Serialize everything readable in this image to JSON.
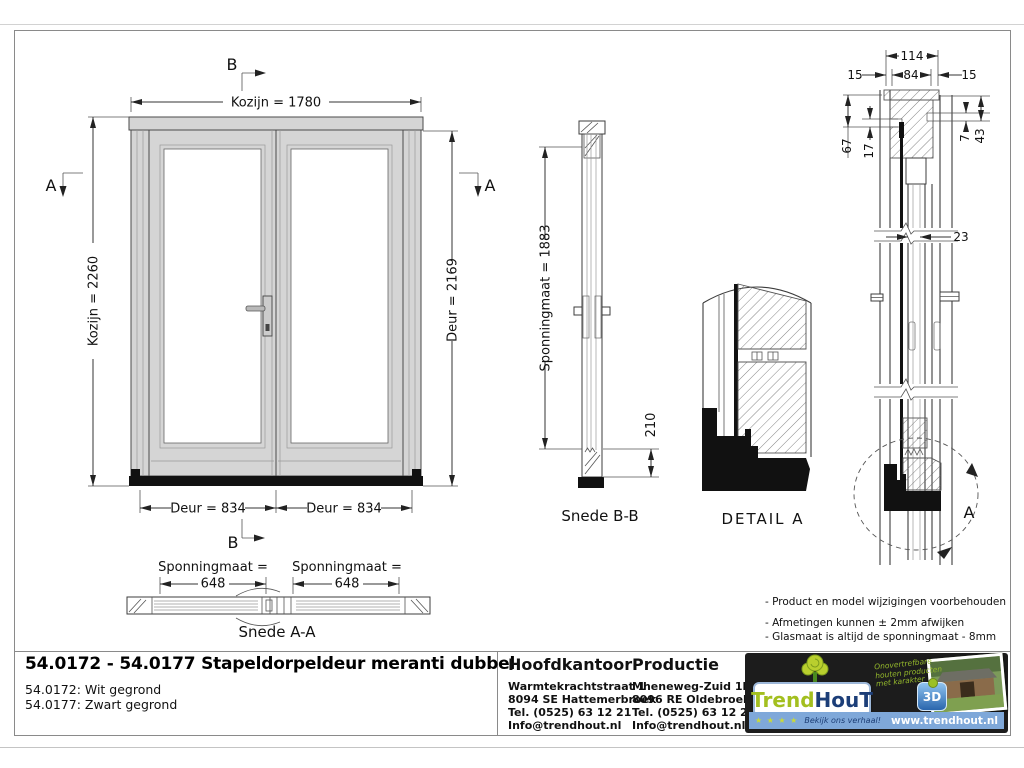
{
  "drawing": {
    "front_view": {
      "dim_width_top": "Kozijn = 1780",
      "dim_height_left": "Kozijn = 2260",
      "dim_height_right": "Deur = 2169",
      "dim_door_left": "Deur = 834",
      "dim_door_right": "Deur = 834",
      "marker_b": "B",
      "marker_a": "A"
    },
    "snede_aa": {
      "dim_label_left": "Sponningmaat =",
      "dim_value_left": "648",
      "dim_label_right": "Sponningmaat =",
      "dim_value_right": "648",
      "caption": "Snede A-A"
    },
    "snede_bb": {
      "dim_height": "Sponningmaat = 1883",
      "dim_bottom": "210",
      "caption": "Snede B-B"
    },
    "detail_a": {
      "caption": "DETAIL  A"
    },
    "profile": {
      "dim_114": "114",
      "dim_84": "84",
      "dim_15_left": "15",
      "dim_15_right": "15",
      "dim_67": "67",
      "dim_17": "17",
      "dim_7": "7",
      "dim_43": "43",
      "dim_23": "23",
      "marker_a": "A"
    },
    "notes": {
      "line1": "- Product en model wijzigingen voorbehouden",
      "line2": "- Afmetingen kunnen ± 2mm afwijken",
      "line3": "- Glasmaat is altijd de sponningmaat - 8mm"
    }
  },
  "title_block": {
    "title": "54.0172 - 54.0177 Stapeldorpeldeur meranti dubbel",
    "variant_1": "54.0172: Wit gegrond",
    "variant_2": "54.0177: Zwart gegrond",
    "hoofdkantoor": {
      "heading": "Hoofdkantoor",
      "address_1": "Warmtekrachtstraat 1",
      "address_2": "8094 SE Hattemerbroek",
      "phone": "Tel. (0525) 63 12 21",
      "email": "Info@trendhout.nl"
    },
    "productie": {
      "heading": "Productie",
      "address_1": "Mheneweg-Zuid 1b",
      "address_2": "8096 RE Oldebroek",
      "phone": "Tel. (0525) 63 12 21",
      "email": "Info@trendhout.nl"
    },
    "logo": {
      "brand_part1": "Trend",
      "brand_part2": "HouT",
      "tagline_1": "Onovertrefbare",
      "tagline_2": "houten producten",
      "tagline_3": "met karakter",
      "badge": "3D",
      "stars": "★ ★ ★ ★",
      "slogan": "Bekijk ons verhaal!",
      "website": "www.trendhout.nl"
    },
    "colors": {
      "brand_green": "#a3bf1f",
      "brand_blue": "#1c3e78",
      "bar_blue": "#7fa8d9",
      "logo_bg": "#1c1c1c"
    }
  }
}
